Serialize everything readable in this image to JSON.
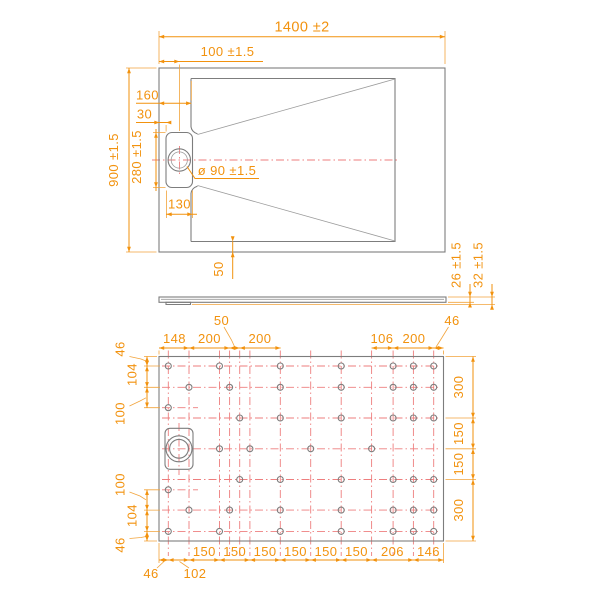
{
  "drawing_type": "shower tray technical drawing, three orthographic views",
  "colors": {
    "dimension_orange": "#f2920e",
    "outline_gray": "#7d7d7d",
    "centerline_red": "#ee7e7e",
    "background": "#ffffff"
  },
  "top_view": {
    "overall_width": "1400 ±2",
    "drain_center_from_left": "100 ±1.5",
    "overall_depth": "900 ±1.5",
    "floor_inset_left": "160",
    "recess_side_offset": "30",
    "recess_length": "280 ±1.5",
    "recess_width": "130",
    "drain_diameter": "ø 90 ±1.5",
    "floor_inset_bottom": "50"
  },
  "side_view": {
    "tray_thickness": "26 ±1.5",
    "overall_height": "32 ±1.5"
  },
  "bottom_view": {
    "top_dims": [
      "148",
      "200",
      "50",
      "200",
      "106",
      "200",
      "46"
    ],
    "bottom_dims": [
      "46",
      "102",
      "150",
      "150",
      "150",
      "150",
      "150",
      "150",
      "206",
      "146"
    ],
    "left_dims": [
      "46",
      "104",
      "100",
      "100",
      "104",
      "46"
    ],
    "right_dims": [
      "300",
      "150",
      "150",
      "300"
    ]
  }
}
